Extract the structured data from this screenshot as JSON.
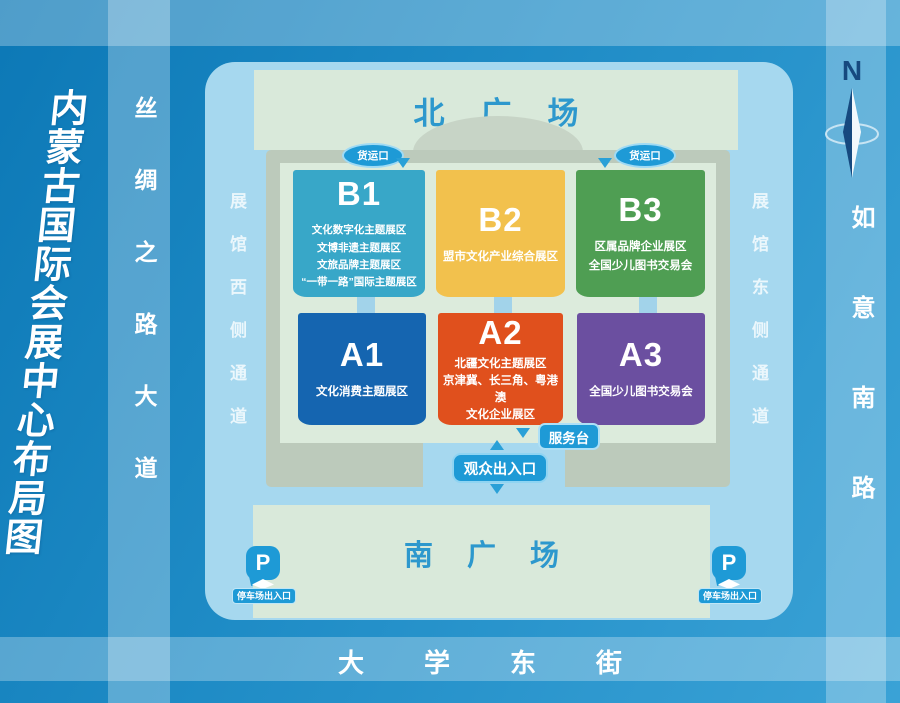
{
  "title": "内蒙古国际会展中心布局图",
  "roads": {
    "west": "丝绸之路大道",
    "east": "如意南路",
    "south": "大学东街"
  },
  "compass": {
    "label": "N"
  },
  "corridors": {
    "west": "展馆西侧通道",
    "east": "展馆东侧通道"
  },
  "plazas": {
    "north": "北广场",
    "south": "南广场"
  },
  "halls": [
    {
      "id": "B1",
      "color": "#38a7c8",
      "lines": [
        "文化数字化主题展区",
        "文博非遗主题展区",
        "文旅品牌主题展区",
        "“一带一路”国际主题展区"
      ]
    },
    {
      "id": "B2",
      "color": "#f2c14d",
      "lines": [
        "盟市文化产业综合展区"
      ]
    },
    {
      "id": "B3",
      "color": "#4f9e53",
      "lines": [
        "区属品牌企业展区",
        "全国少儿图书交易会"
      ]
    },
    {
      "id": "A1",
      "color": "#1565b0",
      "lines": [
        "文化消费主题展区"
      ]
    },
    {
      "id": "A2",
      "color": "#e0501d",
      "lines": [
        "北疆文化主题展区",
        "京津冀、长三角、粤港澳",
        "文化企业展区"
      ]
    },
    {
      "id": "A3",
      "color": "#6b4fa0",
      "lines": [
        "全国少儿图书交易会"
      ]
    }
  ],
  "markers": {
    "freight": "货运口",
    "service_desk": "服务台",
    "visitor_entrance": "观众出入口",
    "parking": "停车场出入口",
    "parking_letter": "P"
  },
  "colors": {
    "background": "#1f8cc6",
    "venue": "#a6d8ef",
    "plaza": "#d9e9da",
    "building_wall": "#bccabb",
    "building_inner": "#dcebdc",
    "accent_blue": "#1e9ad6",
    "plaza_text": "#2d98cd",
    "compass_navy": "#16497f"
  }
}
